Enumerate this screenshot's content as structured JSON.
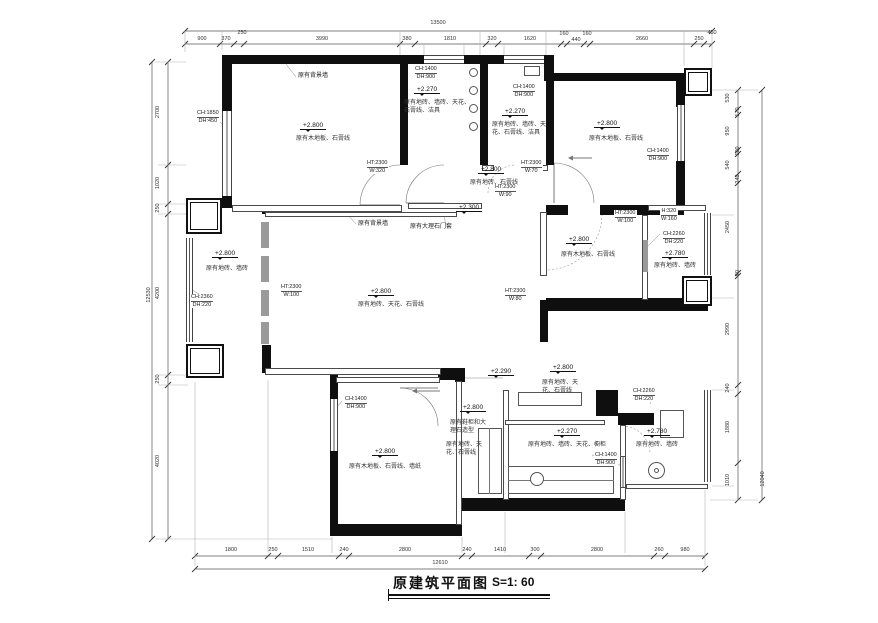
{
  "title": {
    "text": "原建筑平面图",
    "scale": "S=1: 60"
  },
  "dims": {
    "top": {
      "total": "13500",
      "segments": [
        "900",
        "370",
        "250",
        "3990",
        "380",
        "1810",
        "320",
        "1620",
        "160",
        "440",
        "160",
        "2660",
        "250",
        "450"
      ]
    },
    "bottom": {
      "total": "12610",
      "segments": [
        "1800",
        "250",
        "1510",
        "240",
        "2800",
        "240",
        "1410",
        "300",
        "2800",
        "260",
        "980"
      ]
    },
    "left": {
      "total": "12530",
      "segments": [
        "2700",
        "1020",
        "250",
        "4200",
        "250",
        "4020"
      ]
    },
    "right": {
      "total": "12040",
      "segments": [
        "530",
        "170",
        "950",
        "100",
        "540",
        "240",
        "2450",
        "90",
        "2990",
        "240",
        "1880",
        "1010"
      ]
    }
  },
  "rooms": {
    "bedroom_tl": {
      "level": "+2.800",
      "finish": "原有木地板、石膏线"
    },
    "bath_a": {
      "level": "+2.270",
      "finish": "原有地砖、墙砖、天花、石膏线、洁具"
    },
    "bath_b": {
      "level": "+2.270",
      "finish": "原有地砖、墙砖、天花、石膏线、洁具"
    },
    "bedroom_tr": {
      "level": "+2.800",
      "finish": "原有木地板、石膏线"
    },
    "hallway": {
      "level": "+2.800",
      "finish": "原有地砖、石膏线"
    },
    "living": {
      "level": "+2.800",
      "finish": "原有地砖、天花、石膏线"
    },
    "balcony_left": {
      "level": "+2.800",
      "finish": "原有地砖、墙砖"
    },
    "bedroom_mr": {
      "level": "+2.800",
      "finish": "原有木地板、石膏线"
    },
    "balcony_mr": {
      "level": "+2.780",
      "finish": "原有地砖、墙砖"
    },
    "bedroom_bl": {
      "level": "+2.800",
      "finish": "原有木地板、石膏线、墙纸"
    },
    "entry": {
      "level": "+2.800",
      "finish_a": "原有鞋柜和大理石造型",
      "finish_b": "原有地砖、天花、石膏线"
    },
    "dining": {
      "level": "+2.800",
      "finish": "原有地砖、天花、石膏线"
    },
    "kitchen": {
      "level": "+2.270",
      "finish": "原有地砖、墙砖、天花、橱柜"
    },
    "balcony_br": {
      "level": "+2.780",
      "finish": "原有地砖、墙砖"
    }
  },
  "specs": {
    "win_master": [
      "CH:1850",
      "DH:450"
    ],
    "win_bath_a": [
      "CH:1400",
      "DH:900"
    ],
    "win_bath_b": [
      "CH:1400",
      "DH:900"
    ],
    "win_bed_tr": [
      "CH:1400",
      "DH:900"
    ],
    "door_bed_tl": [
      "HT:2300",
      "W:320"
    ],
    "door_w70": [
      "HT:2300",
      "W:70"
    ],
    "door_w90": [
      "HT:2300",
      "W:90"
    ],
    "door_w80": [
      "HT:2300",
      "W:80"
    ],
    "door_w100_living": [
      "HT:2300",
      "W:100"
    ],
    "door_w100_mr": [
      "HT:2300",
      "W:100"
    ],
    "niche": [
      "H:320",
      "W:160"
    ],
    "win_bal_mr": [
      "CH:2260",
      "DH:220"
    ],
    "win_bal_left": [
      "CH:2360",
      "DH:220"
    ],
    "win_bed_bl": [
      "CH:1400",
      "DH:900"
    ],
    "win_kitchen": [
      "CH:1400",
      "DH:900"
    ],
    "win_bal_br": [
      "CH:2260",
      "DH:220"
    ]
  },
  "annotations": {
    "bg_wall_top": "原有背景墙",
    "bg_wall_living": "原有背景墙",
    "marble_door_frame": "原有大理石门套",
    "step_living": "+2.300",
    "step_dining": "+2.290"
  }
}
